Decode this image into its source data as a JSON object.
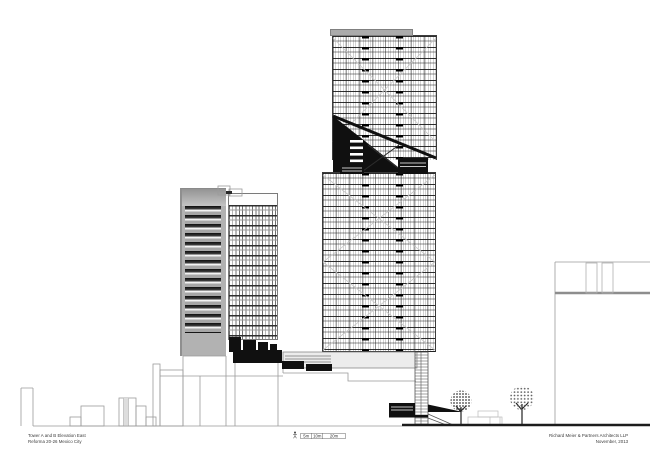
{
  "title_block": {
    "project": "Tower A and B Elevation East",
    "location": "Reforma 20-26 Mexico City"
  },
  "credit_block": {
    "firm": "Richard Meier & Partners Architects LLP",
    "date": "November, 2013"
  },
  "scale_bar": {
    "labels": [
      "5m",
      "10m",
      "20m"
    ]
  },
  "icons": {
    "scale_figure": "person-icon",
    "trees": "tree-icon"
  },
  "colors": {
    "paper": "#ffffff",
    "line_gray": "#9b9b9b",
    "dark_ink": "#101010",
    "facade_gray": "#b2b2b2",
    "ground_ink": "#1c1c1c"
  }
}
